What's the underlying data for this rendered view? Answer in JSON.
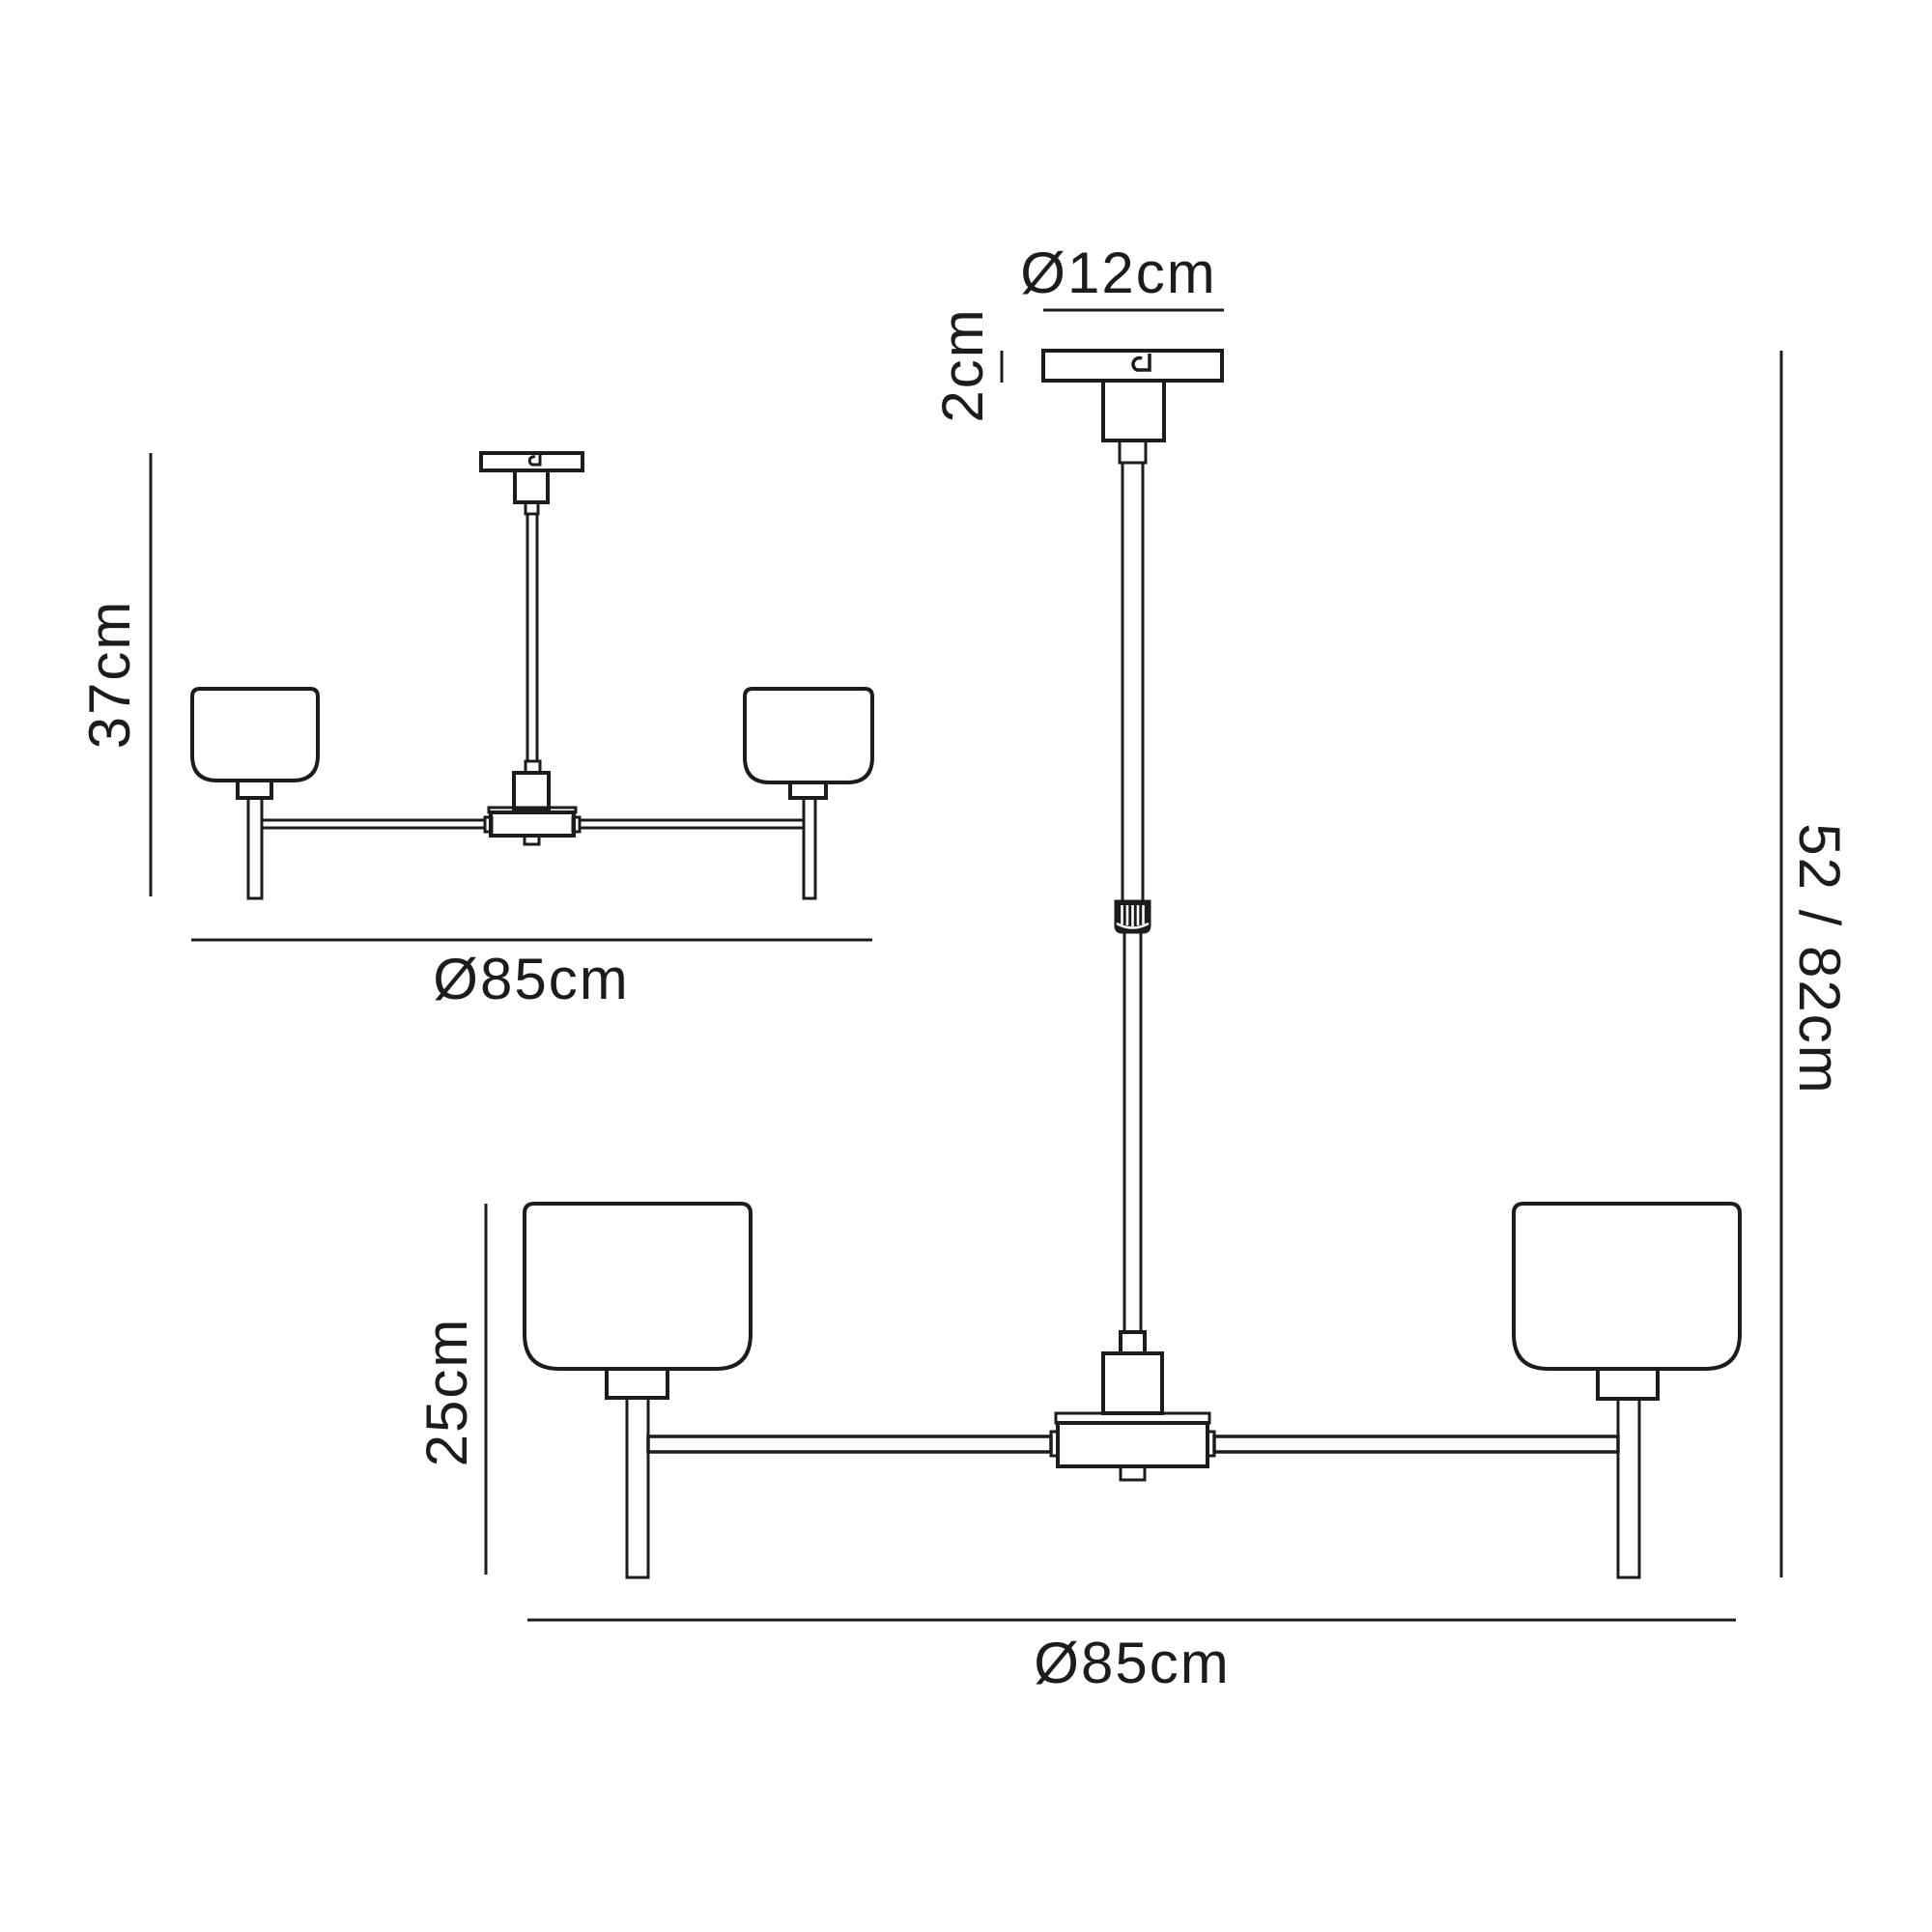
{
  "colors": {
    "ink": "#1c1c1c",
    "background": "#ffffff"
  },
  "labels": {
    "small_height": "37cm",
    "small_diameter": "Ø85cm",
    "canopy_diameter": "Ø12cm",
    "canopy_height": "2cm",
    "shade_height": "25cm",
    "large_diameter": "Ø85cm",
    "drop": "52 / 82cm"
  }
}
